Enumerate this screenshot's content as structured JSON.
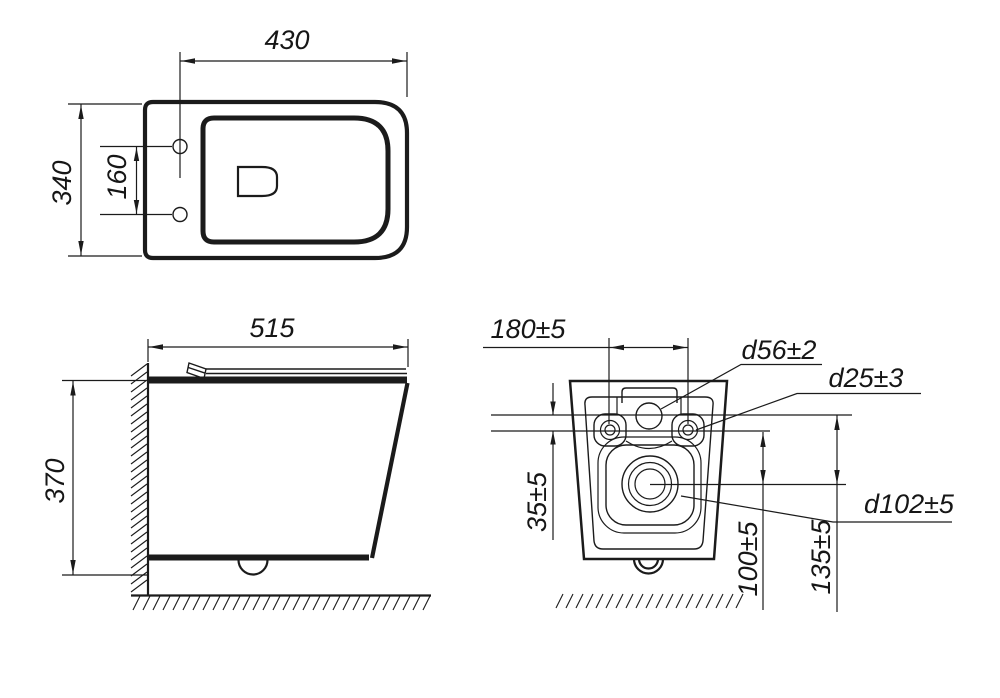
{
  "drawing": {
    "type": "technical-dimension-drawing",
    "subject": "wall-hung toilet, three orthographic views",
    "colors": {
      "line": "#1b1b1b",
      "background": "#ffffff"
    },
    "views": {
      "top": {
        "width": "430",
        "depth": "340",
        "hinge_hole_spacing": "160"
      },
      "side": {
        "depth": "515",
        "height": "370"
      },
      "rear": {
        "bolt_spacing": "180±5",
        "inlet_to_bolt_offset": "35±5",
        "inlet_diameter": "d56±2",
        "bolt_hole_diameter": "d25±3",
        "outlet_diameter": "d102±5",
        "outlet_axis_dim": "100±5",
        "inlet_axis_dim": "135±5"
      }
    }
  }
}
